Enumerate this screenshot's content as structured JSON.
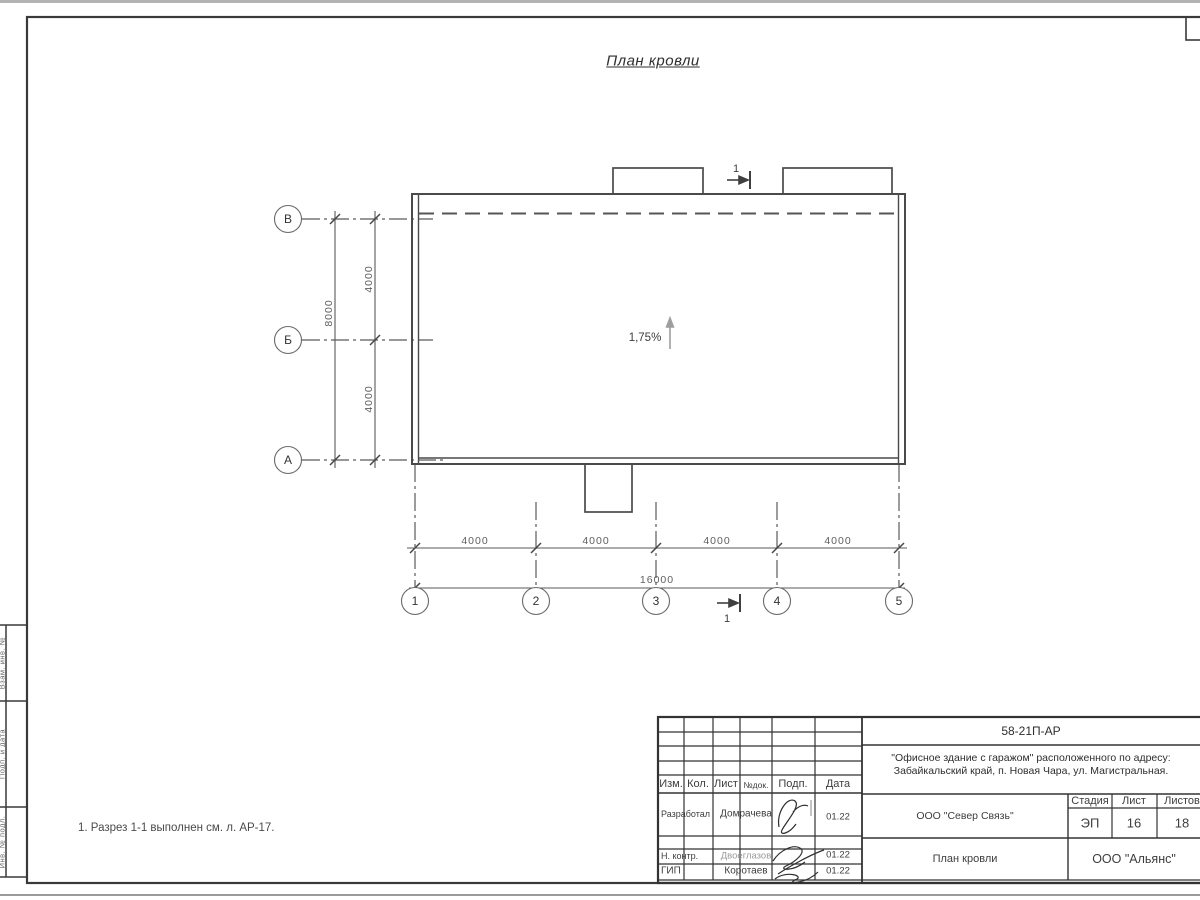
{
  "drawing": {
    "title": "План кровли",
    "slope_label": "1,75%",
    "note": "1. Разрез 1-1 выполнен см. л. АР-17.",
    "section_marker_top": "1",
    "section_marker_bottom": "1",
    "axes": {
      "rows": [
        "В",
        "Б",
        "А"
      ],
      "cols": [
        "1",
        "2",
        "3",
        "4",
        "5"
      ]
    },
    "dimensions": {
      "left_segment_top": "4000",
      "left_segment_bottom": "4000",
      "left_total": "8000",
      "bottom_segments": [
        "4000",
        "4000",
        "4000",
        "4000"
      ],
      "bottom_total": "16000"
    }
  },
  "frame_strip": {
    "cells": [
      "Взам. инв. №",
      "Подп. и дата",
      "Инв. № подл."
    ]
  },
  "title_block": {
    "doc_number": "58-21П-АР",
    "project_line1": "\"Офисное здание с гаражом\" расположенного по адресу:",
    "project_line2": "Забайкальский край, п. Новая Чара, ул. Магистральная.",
    "customer": "ООО \"Север Связь\"",
    "sheet_title": "План кровли",
    "company": "ООО \"Альянс\"",
    "stage_label": "Стадия",
    "sheet_label": "Лист",
    "sheets_label": "Листов",
    "stage": "ЭП",
    "sheet": "16",
    "sheets": "18",
    "header_cols": [
      "Изм.",
      "Кол.",
      "Лист",
      "№док.",
      "Подп.",
      "Дата"
    ],
    "rows": [
      {
        "role": "Разработал",
        "name": "Домрачева",
        "date": "01.22"
      },
      {
        "role": "Н. контр.",
        "name": "Двоеглазов",
        "date": "01.22"
      },
      {
        "role": "ГИП",
        "name": "Коротаев",
        "date": "01.22"
      }
    ]
  }
}
